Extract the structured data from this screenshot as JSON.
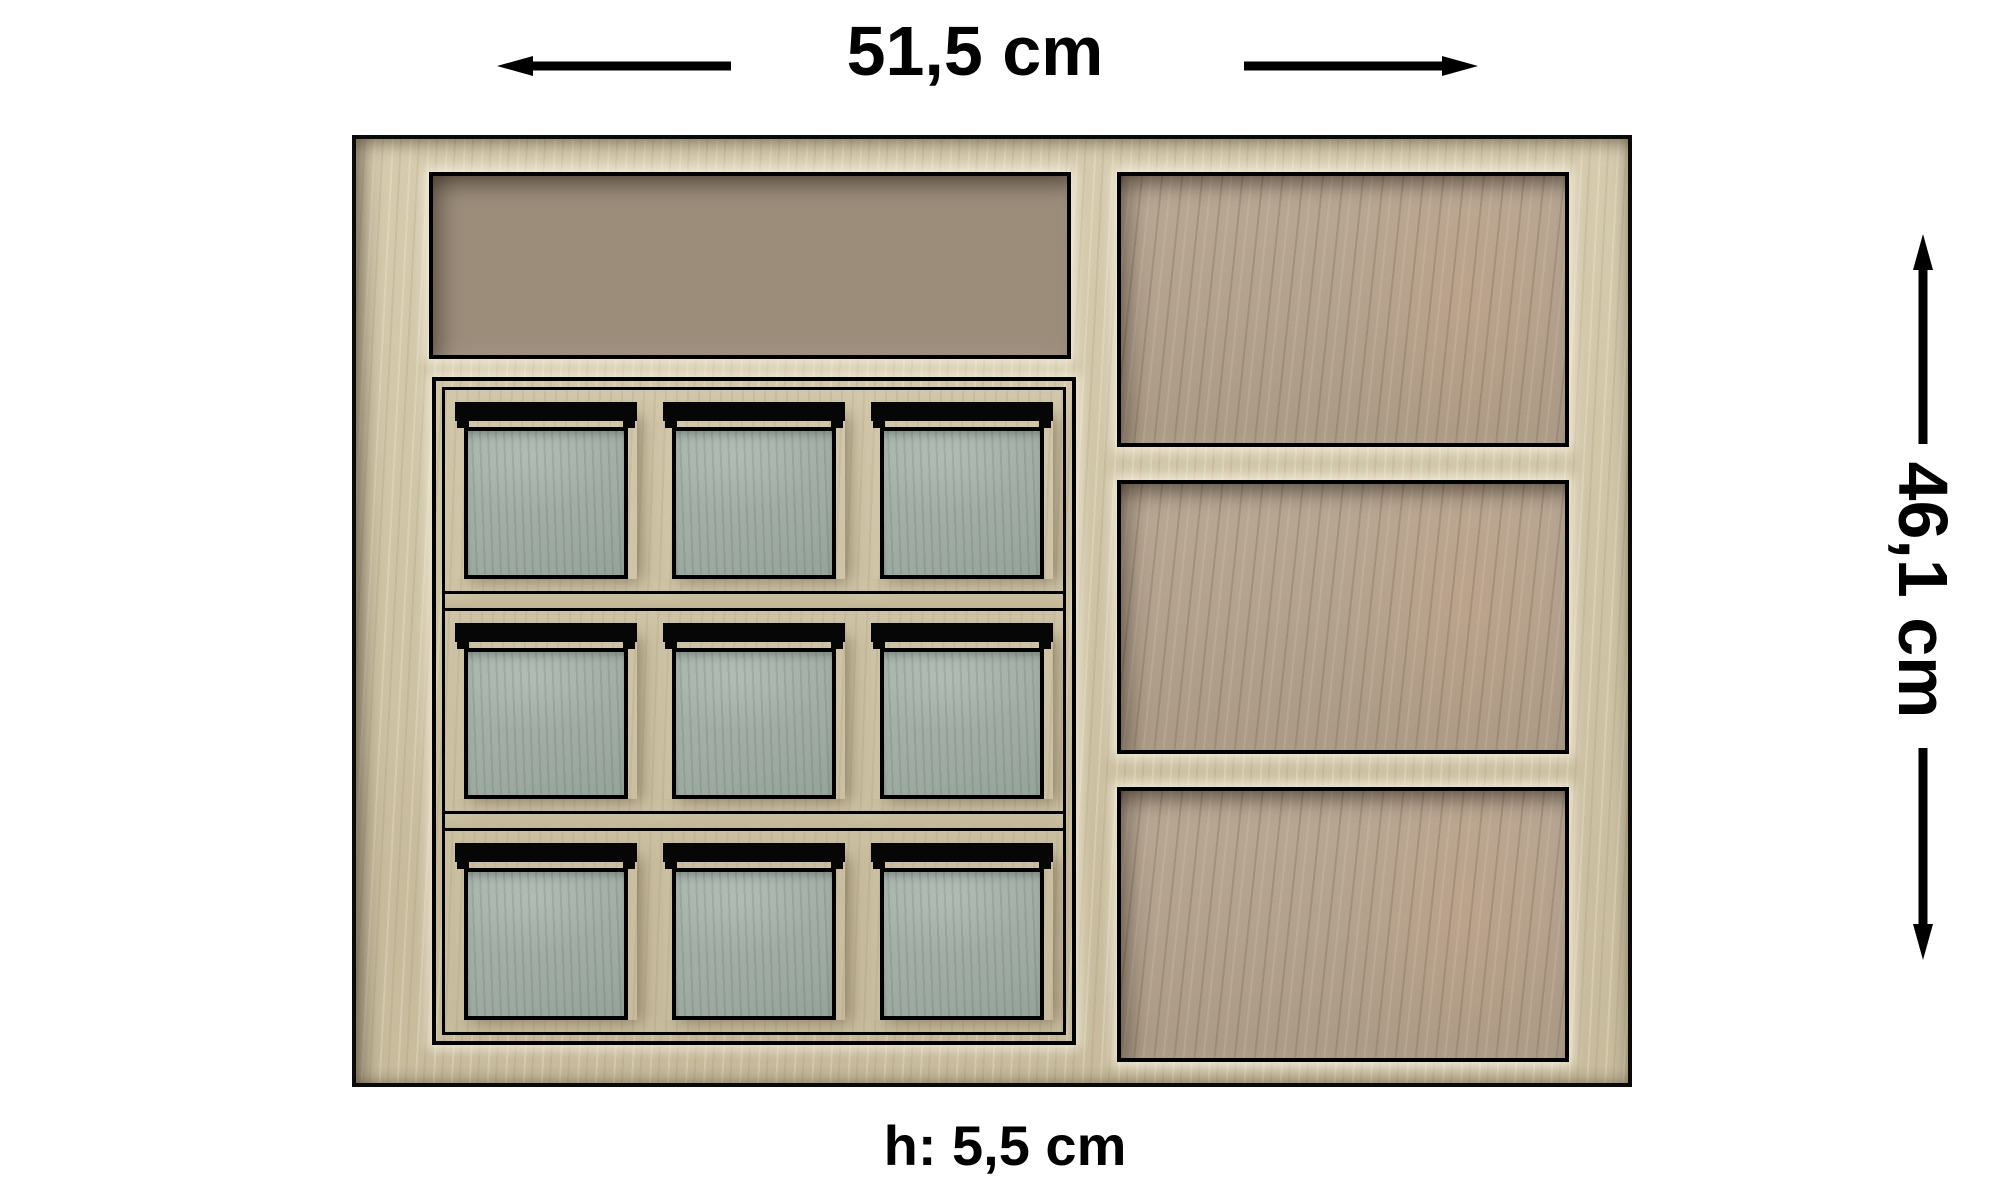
{
  "annotations": {
    "width_label": "51,5 cm",
    "height_label": "46,1 cm",
    "depth_label": "h: 5,5 cm"
  },
  "tray": {
    "description": "wooden organizer tray insert, top view",
    "open_compartments_left": 1,
    "card_grid": {
      "rows": 3,
      "columns": 3
    },
    "right_compartments": 3
  },
  "colors": {
    "background": "#ffffff",
    "annotation_text": "#000000",
    "outline": "#000000",
    "frame_wood": "#cfc4a6",
    "frame_wood_highlight": "#e7dfc4",
    "open_compartment_wood": "#9c8d7b",
    "right_compartment_wood": "#b2a18d",
    "card_panel_wood": "#a1ada5",
    "card_slot": "#060606"
  }
}
